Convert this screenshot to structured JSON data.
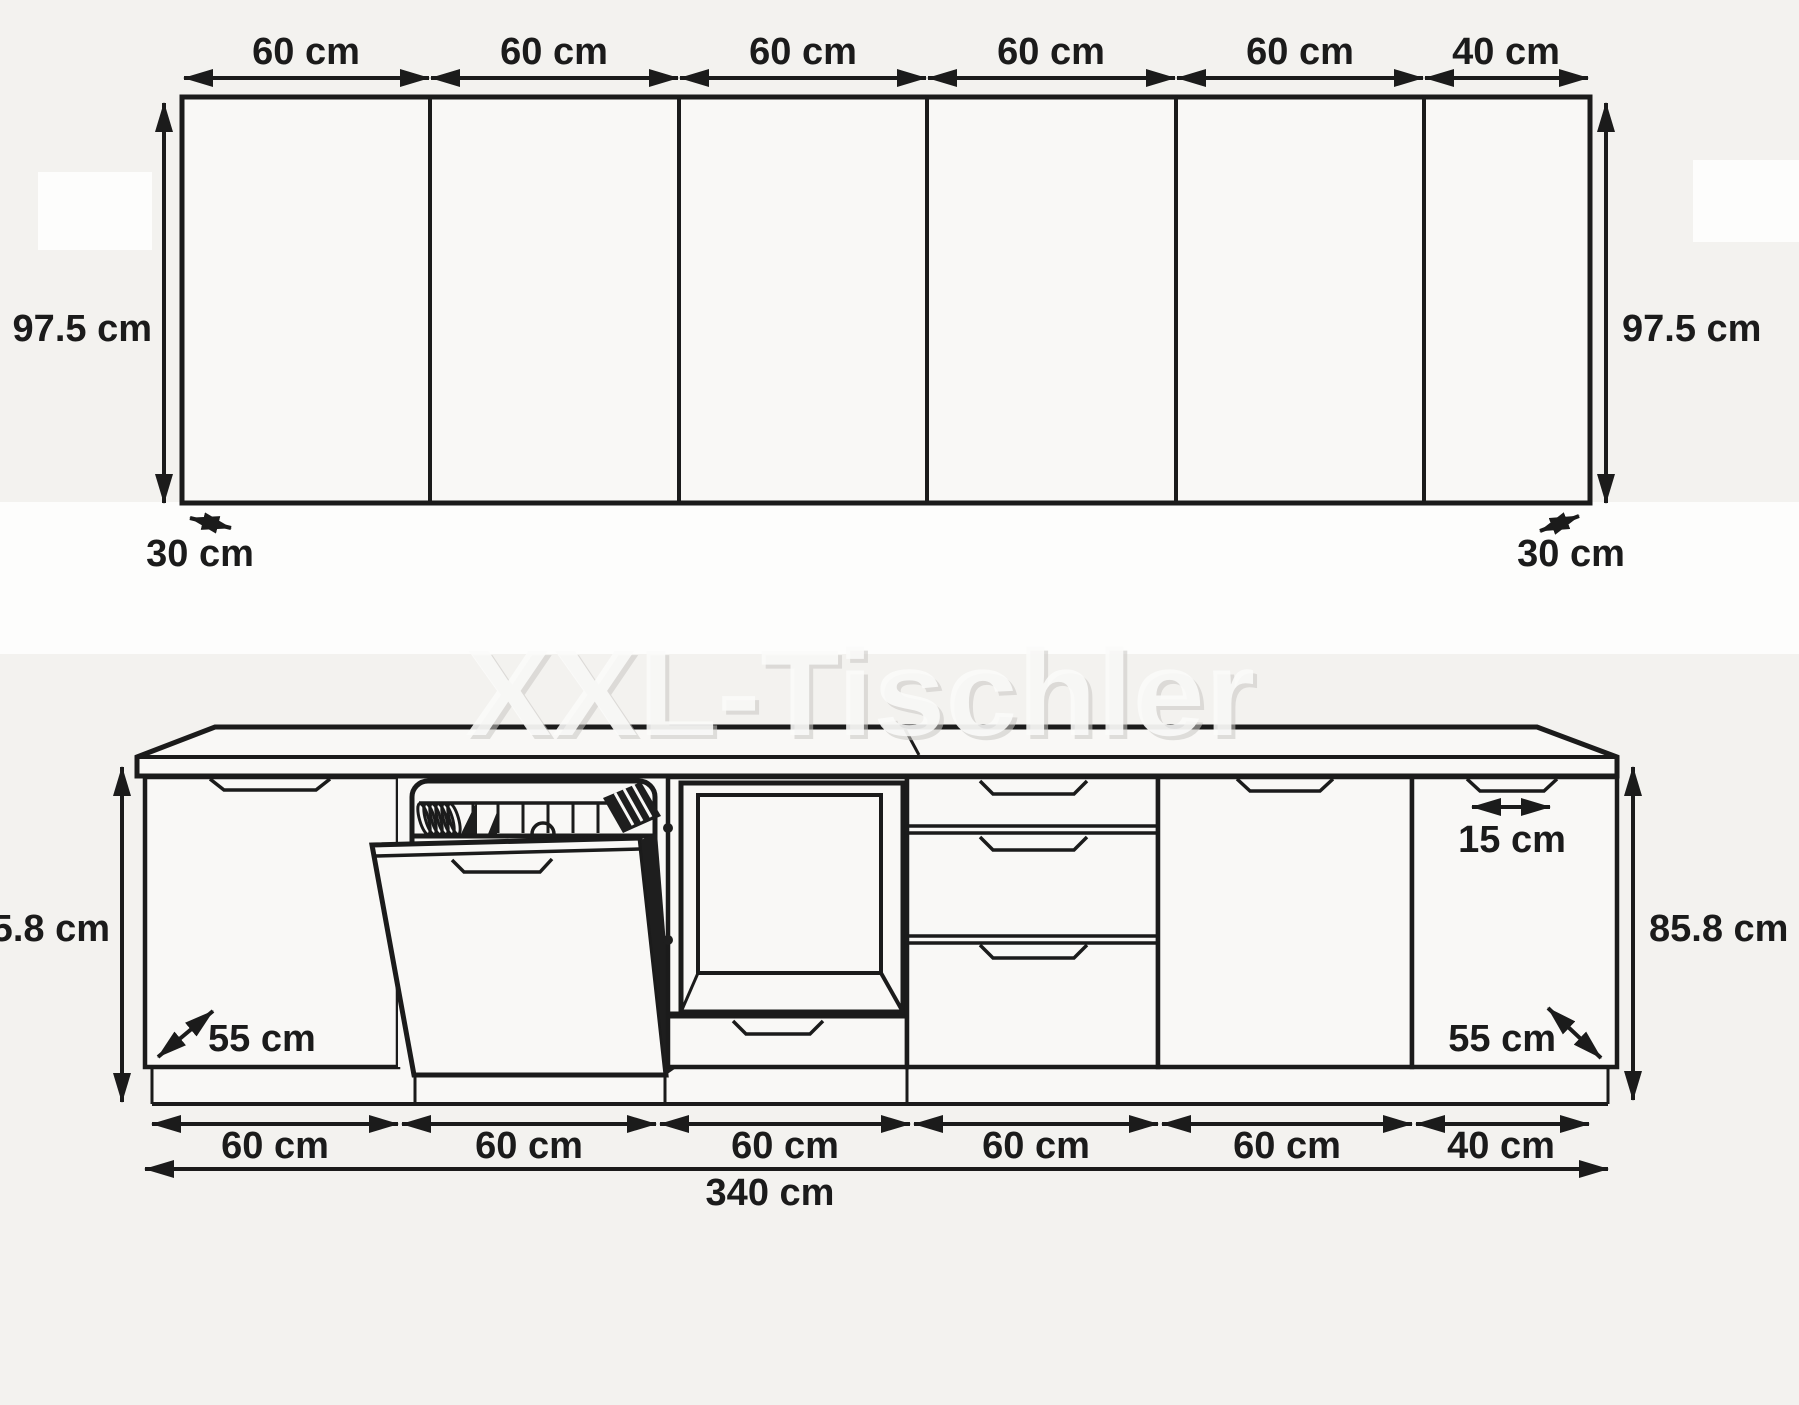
{
  "watermark": "XXL-Tischler",
  "wall_units": {
    "widths": [
      "60 cm",
      "60 cm",
      "60 cm",
      "60 cm",
      "60 cm",
      "40 cm"
    ],
    "height_left": "97.5 cm",
    "height_right": "97.5 cm",
    "depth_left": "30 cm",
    "depth_right": "30 cm"
  },
  "base_units": {
    "widths": [
      "60 cm",
      "60 cm",
      "60 cm",
      "60 cm",
      "60 cm",
      "40 cm"
    ],
    "total_width": "340 cm",
    "height_left": "85.8 cm",
    "height_right": "85.8 cm",
    "depth_left": "55 cm",
    "depth_right": "55 cm",
    "handle_width": "15 cm"
  }
}
